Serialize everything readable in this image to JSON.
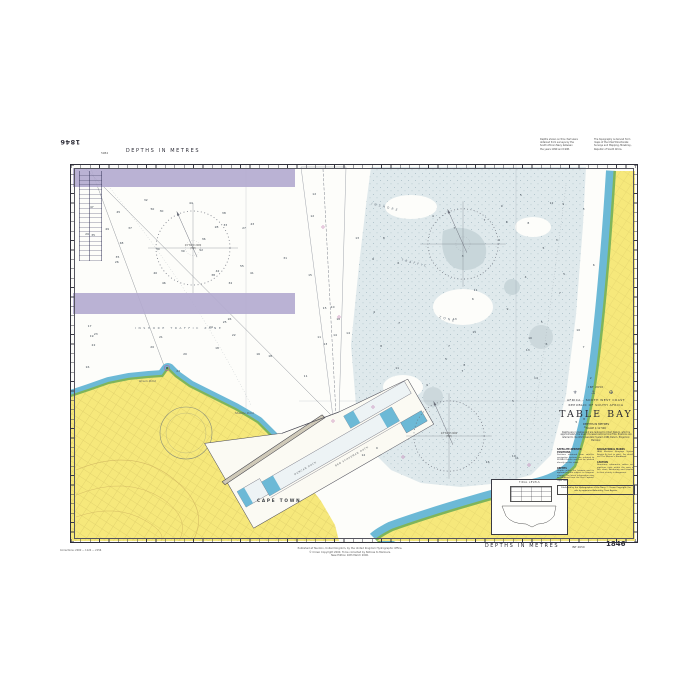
{
  "sheet": {
    "chart_number": "1846",
    "depths_legend": "DEPTHS IN METRES",
    "int_ref": "INT 2650",
    "edition_note": "5984"
  },
  "margins": {
    "top_right_note_1": [
      "Depths shown on this chart were",
      "obtained from surveys by the",
      "South African Navy between",
      "the years 1990 and 1998."
    ],
    "top_right_note_2": [
      "The topography is derived from",
      "maps of the Chief Directorate:",
      "Surveys and Mapping, Mowbray,",
      "Republic of South Africa."
    ],
    "bottom_publication": [
      "Published at Taunton, United Kingdom, by the United Kingdom Hydrographic Office.",
      "© Crown Copyright 2000. To be corrected by Notices to Mariners.",
      "New Edition 16th March 2000."
    ],
    "bottom_corner_note": "Corrections: 2000 — 1124 — 2156"
  },
  "title_block": {
    "int_ref": "INT 2650",
    "emblems": "⚜ ⚓ ✠",
    "region": "AFRICA – SOUTH WEST COAST",
    "country": "REPUBLIC OF SOUTH AFRICA",
    "name": "TABLE BAY",
    "depths_note": "DEPTHS IN METRES",
    "scale_note": "SCALE 1:12 500",
    "datum_para": "Depths are in metres and are reduced to Chart Datum, which is approximately the level of Lowest Astronomical Tide. Positions are referred to the World Geodetic System 1984 Datum. Projection: Mercator.",
    "notes": [
      {
        "h": "SATELLITE-DERIVED POSITIONS",
        "b": "Positions obtained from satellite navigation systems are referred to WGS84 Datum and can be plotted directly on this chart."
      },
      {
        "h": "DEPTHS",
        "b": "Depths within the harbour and its approaches are subject to frequent change. The latest information may be obtained from the Port Captain, Cape Town."
      },
      {
        "h": "NAVIGATIONAL MARKS",
        "b": "IALA Maritime Buoyage System Region A (red to port). For details see The Mariner's Handbook."
      },
      {
        "h": "CAUTION",
        "b": "Numerous submarine cables and pipelines exist within the area of this chart. Anchoring and trawling in their vicinity is dangerous."
      }
    ],
    "publication": "Published by the Hydrographer of the Navy. © Crown Copyright. For sale by appointed Admiralty Chart Agents."
  },
  "labels": {
    "traffic_zone": "INSHORE TRAFFIC ZONE",
    "tz_word1": "INSHORE",
    "tz_word2": "TRAFFIC",
    "tz_word3": "ZONE",
    "cape_town": "CAPE TOWN",
    "green_point": "Green Point",
    "mouille_point": "Mouille Point",
    "duncan_dock": "DUNCAN DOCK",
    "ben_schoeman": "BEN SCHOEMAN DOCK"
  },
  "compass": {
    "variation": "24°30'W 2000",
    "change": "(5'E)"
  },
  "inset": {
    "caption": "TIDAL LEVELS"
  },
  "colors": {
    "land": "#f6e87b",
    "shallow_blue": "#6cb9d6",
    "intertidal_green": "#7fb55a",
    "traffic_zone": "#b3aacf",
    "bay_tint": "#dfe9ec"
  },
  "soundings": {
    "values": [
      "55",
      "52",
      "50",
      "49",
      "48",
      "47",
      "46",
      "45",
      "44",
      "43",
      "42",
      "41",
      "40",
      "39",
      "38",
      "38",
      "37",
      "36",
      "35",
      "35",
      "34",
      "33",
      "32",
      "31",
      "30",
      "30",
      "29",
      "28",
      "27",
      "26",
      "26",
      "25",
      "24",
      "24",
      "23",
      "22",
      "22",
      "21",
      "20",
      "20",
      "19",
      "18",
      "18",
      "17",
      "16",
      "16",
      "15",
      "15",
      "14",
      "14",
      "13",
      "13",
      "12",
      "12",
      "11",
      "11",
      "10",
      "10",
      "9",
      "9",
      "8",
      "8",
      "8",
      "7",
      "7",
      "7",
      "6",
      "6",
      "6",
      "5",
      "5",
      "5",
      "4",
      "4",
      "3",
      "3",
      "12",
      "11",
      "10",
      "9",
      "8",
      "7",
      "6",
      "5",
      "14",
      "13",
      "12",
      "11",
      "10",
      "9",
      "8",
      "7",
      "6",
      "5",
      "4",
      "16",
      "15",
      "13",
      "11",
      "9",
      "7",
      "5",
      "4",
      "3",
      "2",
      "6",
      "8",
      "10",
      "5",
      "7",
      "9",
      "3",
      "4",
      "6"
    ],
    "regions": [
      {
        "x": 12,
        "y": 34,
        "w": 205,
        "h": 88,
        "count": 30
      },
      {
        "x": 12,
        "y": 154,
        "w": 195,
        "h": 54,
        "count": 16
      },
      {
        "x": 232,
        "y": 10,
        "w": 58,
        "h": 238,
        "count": 12
      },
      {
        "x": 300,
        "y": 10,
        "w": 198,
        "h": 118,
        "count": 20
      },
      {
        "x": 292,
        "y": 132,
        "w": 195,
        "h": 165,
        "count": 24
      },
      {
        "x": 505,
        "y": 14,
        "w": 20,
        "h": 285,
        "count": 8
      }
    ]
  }
}
